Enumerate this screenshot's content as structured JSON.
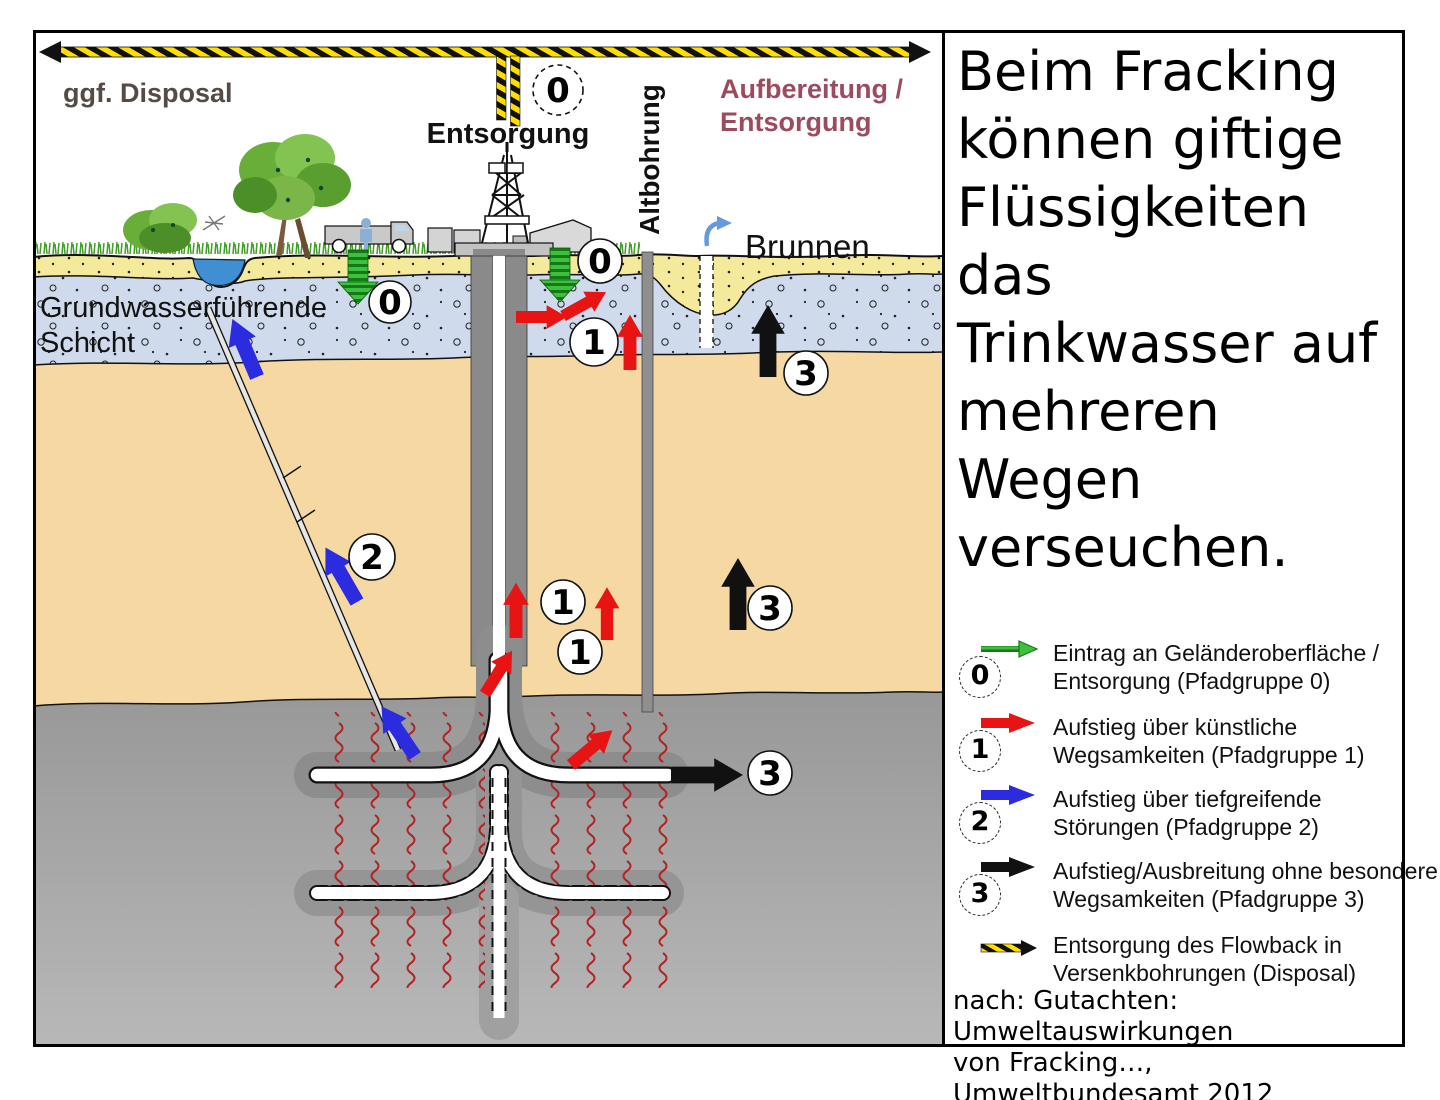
{
  "diagram": {
    "disposal_label": "ggf. Disposal",
    "entsorgung_label": "Entsorgung",
    "aufbereitung_line1": "Aufbereitung /",
    "aufbereitung_line2": "Entsorgung",
    "altbohrung_label": "Altbohrung",
    "brunnen_label": "Brunnen",
    "aquifer_line1": "Grundwasserführende",
    "aquifer_line2": "Schicht",
    "markers": {
      "g0": "0",
      "g1": "1",
      "g2": "2",
      "g3": "3"
    }
  },
  "panel": {
    "title_lines": [
      "Beim Fracking",
      "können giftige",
      "Flüssigkeiten das",
      "Trinkwasser auf",
      "mehreren Wegen",
      "verseuchen."
    ]
  },
  "legend": {
    "items": [
      {
        "num": "0",
        "line1": "Eintrag an Geländeroberfläche /",
        "line2": "Entsorgung (Pfadgruppe 0)"
      },
      {
        "num": "1",
        "line1": "Aufstieg über künstliche",
        "line2": "Wegsamkeiten (Pfadgruppe 1)"
      },
      {
        "num": "2",
        "line1": "Aufstieg über tiefgreifende",
        "line2": "Störungen (Pfadgruppe 2)"
      },
      {
        "num": "3",
        "line1": "Aufstieg/Ausbreitung ohne besondere",
        "line2": "Wegsamkeiten (Pfadgruppe 3)"
      },
      {
        "num": "",
        "line1": "Entsorgung des Flowback in",
        "line2": "Versenkbohrungen (Disposal)"
      }
    ],
    "caption_line1": "nach: Gutachten: Umweltauswirkungen",
    "caption_line2": "von Fracking…, Umweltbundesamt 2012"
  },
  "colors": {
    "path0_green": "#3bb53b",
    "path1_red": "#e81313",
    "path2_blue": "#2b2be0",
    "path3_black": "#111111",
    "hazard_yellow": "#ffdf00",
    "aufbereitung_text": "#9c4a5e",
    "disposal_text": "#564b44",
    "aquifer_fill": "#cfdaec",
    "topsoil_fill": "#f5e99b",
    "sandstone_fill": "#f6d8a2",
    "shale_fill": "#a5a5a5"
  }
}
